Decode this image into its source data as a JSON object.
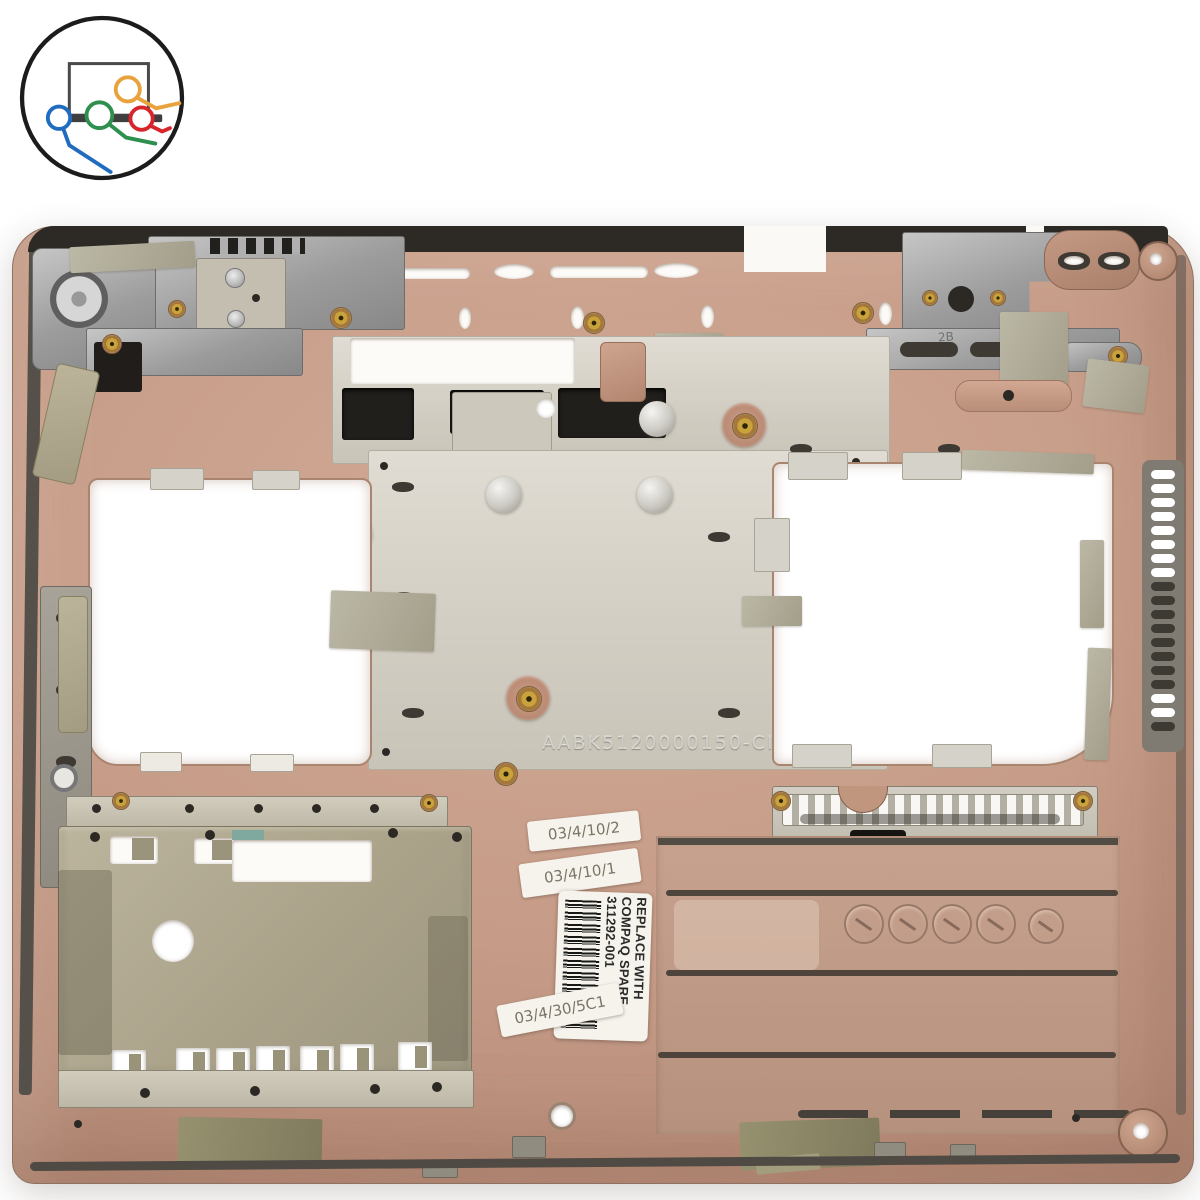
{
  "photo": {
    "subject": "Compaq laptop notebook bottom base cover spare part, underside view",
    "background_color": "#ffffff"
  },
  "logo": {
    "name": "computer-parts-store-logo",
    "description": "laptop silhouette with four colored cable connectors",
    "cable_colors": [
      "#e8a33d",
      "#2e8f4e",
      "#1f6cc0",
      "#d6262b"
    ]
  },
  "labels": {
    "stamped_code": "AABK5120000150-CI",
    "molded_mark": "2B",
    "date_stickers": [
      "03/4/10/2",
      "03/4/10/1",
      "03/4/30/5C1"
    ],
    "spare_label": {
      "line1": "REPLACE WITH",
      "line2": "COMPAQ SPARE",
      "line3": "311292-001"
    }
  },
  "colors": {
    "case_bronze": "#c49a86",
    "plate_gray": "#d6d2c8",
    "shield_olive": "#ada58c",
    "door_tan": "#bf9c8a",
    "trim_black": "#2d2a26",
    "metal_silver": "#a9a9a9",
    "tape_sage": "#b0ac97",
    "tape_olive": "#8d8769"
  }
}
